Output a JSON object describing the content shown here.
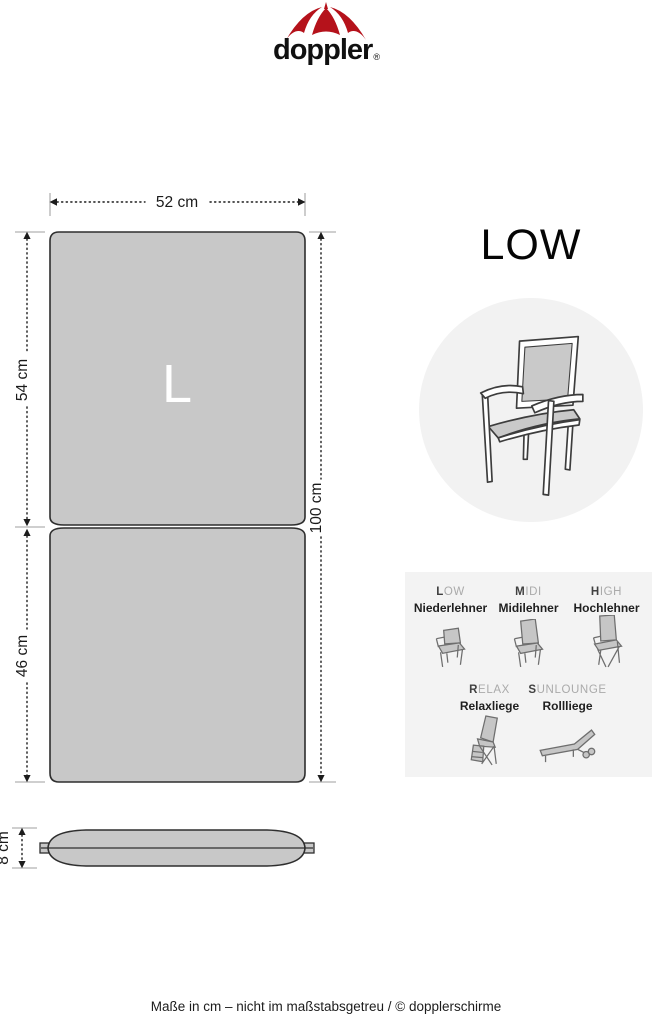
{
  "logo": {
    "wordmark": "doppler",
    "registered": "®"
  },
  "diagram": {
    "size_letter": "L",
    "width_label": "52 cm",
    "upper_height_label": "54 cm",
    "lower_height_label": "46 cm",
    "total_height_label": "100 cm",
    "thickness_label": "8 cm"
  },
  "product": {
    "heading": "LOW"
  },
  "variants": {
    "row1": [
      {
        "code_bold": "L",
        "code_rest": "OW",
        "name": "Niederlehner"
      },
      {
        "code_bold": "M",
        "code_rest": "IDI",
        "name": "Midilehner"
      },
      {
        "code_bold": "H",
        "code_rest": "IGH",
        "name": "Hochlehner"
      }
    ],
    "row2": [
      {
        "code_bold": "R",
        "code_rest": "ELAX",
        "name": "Relaxliege"
      },
      {
        "code_bold": "S",
        "code_rest": "UNLOUNGE",
        "name": "Rollliege"
      }
    ]
  },
  "footer": {
    "note": "Maße in cm – nicht im maßstabsgetreu / © dopplerschirme"
  },
  "colors": {
    "brand_red": "#b5121b",
    "cushion_gray": "#c8c8c8",
    "panel_bg": "#f3f3f3",
    "circle_bg": "#f2f2f2"
  }
}
